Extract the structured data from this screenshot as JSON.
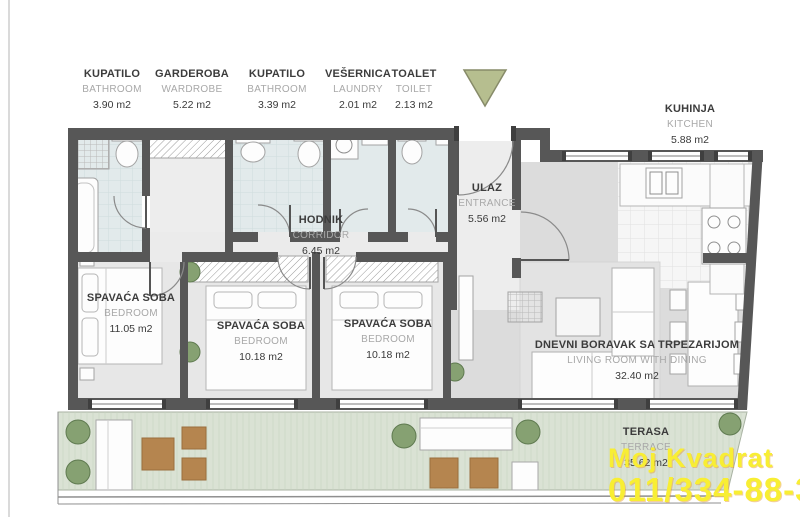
{
  "document_type": "apartment-floor-plan",
  "top_labels": [
    {
      "sr": "KUPATILO",
      "en": "BATHROOM",
      "area": "3.90 m2"
    },
    {
      "sr": "GARDEROBA",
      "en": "WARDROBE",
      "area": "5.22 m2"
    },
    {
      "sr": "KUPATILO",
      "en": "BATHROOM",
      "area": "3.39 m2"
    },
    {
      "sr": "VEŠERNICA",
      "en": "LAUNDRY",
      "area": "2.01 m2"
    },
    {
      "sr": "TOALET",
      "en": "TOILET",
      "area": "2.13 m2"
    }
  ],
  "rooms": {
    "kitchen": {
      "sr": "KUHINJA",
      "en": "KITCHEN",
      "area": "5.88 m2"
    },
    "entrance": {
      "sr": "ULAZ",
      "en": "ENTRANCE",
      "area": "5.56 m2"
    },
    "corridor": {
      "sr": "HODNIK",
      "en": "CORRIDOR",
      "area": "6.45 m2"
    },
    "bedroom1": {
      "sr": "SPAVAĆA SOBA",
      "en": "BEDROOM",
      "area": "11.05 m2"
    },
    "bedroom2": {
      "sr": "SPAVAĆA SOBA",
      "en": "BEDROOM",
      "area": "10.18 m2"
    },
    "bedroom3": {
      "sr": "SPAVAĆA SOBA",
      "en": "BEDROOM",
      "area": "10.18 m2"
    },
    "living": {
      "sr": "DNEVNI BORAVAK SA TRPEZARIJOM",
      "en": "LIVING ROOM WITH DINING",
      "area": "32.40 m2"
    },
    "terrace": {
      "sr": "TERASA",
      "en": "TERRACE",
      "area": "35.62 m2"
    }
  },
  "watermark": {
    "line1": "Moj Kvadrat",
    "line2": "011/334-88-36",
    "color": "#f8ee33"
  },
  "icons": {
    "north_arrow": "triangle-down-orientation-marker"
  },
  "colors": {
    "wall": "#575757",
    "bathroom_floor": "#e2eaeb",
    "hall_floor": "#ededed",
    "bedroom_floor": "#e7e7e7",
    "living_floor": "#dcdcdc",
    "kitchen_floor": "#f6f6f6",
    "terrace_floor": "#dae2d4",
    "wood_furniture": "#b5854f",
    "plant_green": "#86a172",
    "north_arrow_fill": "#b6be8f"
  }
}
